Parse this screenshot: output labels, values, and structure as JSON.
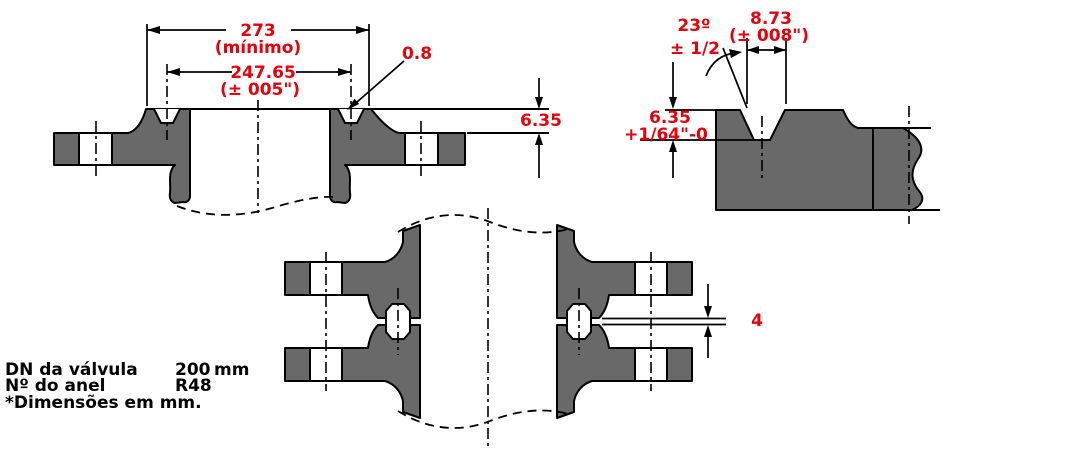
{
  "drawing_title": "ring-joint-flange-drawing",
  "colors": {
    "dimension_red": "#e8000a",
    "steel_gray": "#696969",
    "line_black": "#000000",
    "background": "#ffffff"
  },
  "dimensions": {
    "od": {
      "value": "273",
      "note": "(mínimo)"
    },
    "pitch": {
      "value": "247.65",
      "tolerance": "(± 005\")"
    },
    "corner_radius": {
      "value": "0.8"
    },
    "face_height": {
      "value": "6.35"
    },
    "groove_width": {
      "value": "8.73",
      "tolerance": "(± 008\")"
    },
    "groove_angle": {
      "value": "23º",
      "tolerance": "± 1/2"
    },
    "groove_depth": {
      "value": "6.35",
      "tolerance": "+1/64\"-0"
    },
    "face_gap": {
      "value": "4"
    }
  },
  "notes": {
    "dn_label": "DN da válvula",
    "dn_value": "200",
    "dn_unit": "mm",
    "ring_label": "Nº do anel",
    "ring_value": "R48",
    "units_note": "*Dimensões em mm."
  }
}
